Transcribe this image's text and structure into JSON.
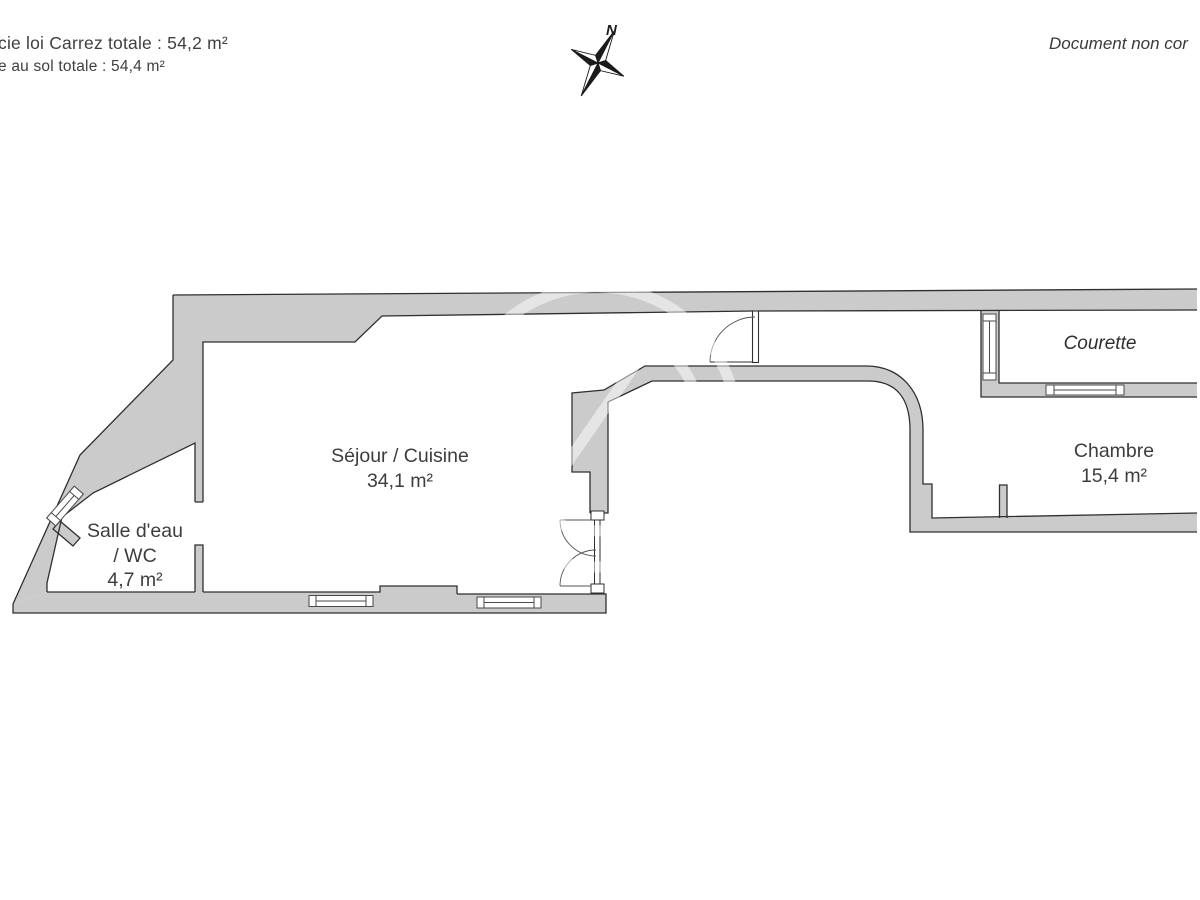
{
  "header": {
    "carrez_total": "cie loi Carrez totale : 54,2 m²",
    "floor_total": "e au sol totale : 54,4 m²",
    "disclaimer": "Document non cor",
    "north": "N"
  },
  "rooms": {
    "sejour": {
      "name": "Séjour / Cuisine",
      "area": "34,1 m²"
    },
    "salle_eau": {
      "name": "Salle d'eau",
      "name_line2": "/ WC",
      "area": "4,7 m²"
    },
    "chambre": {
      "name": "Chambre",
      "area": "15,4 m²"
    },
    "courette": {
      "name": "Courette"
    }
  },
  "colors": {
    "wall_fill": "#cbcbcb",
    "wall_line": "#2f2f2f",
    "text": "#3d3d3d",
    "watermark": "#ffffff"
  }
}
